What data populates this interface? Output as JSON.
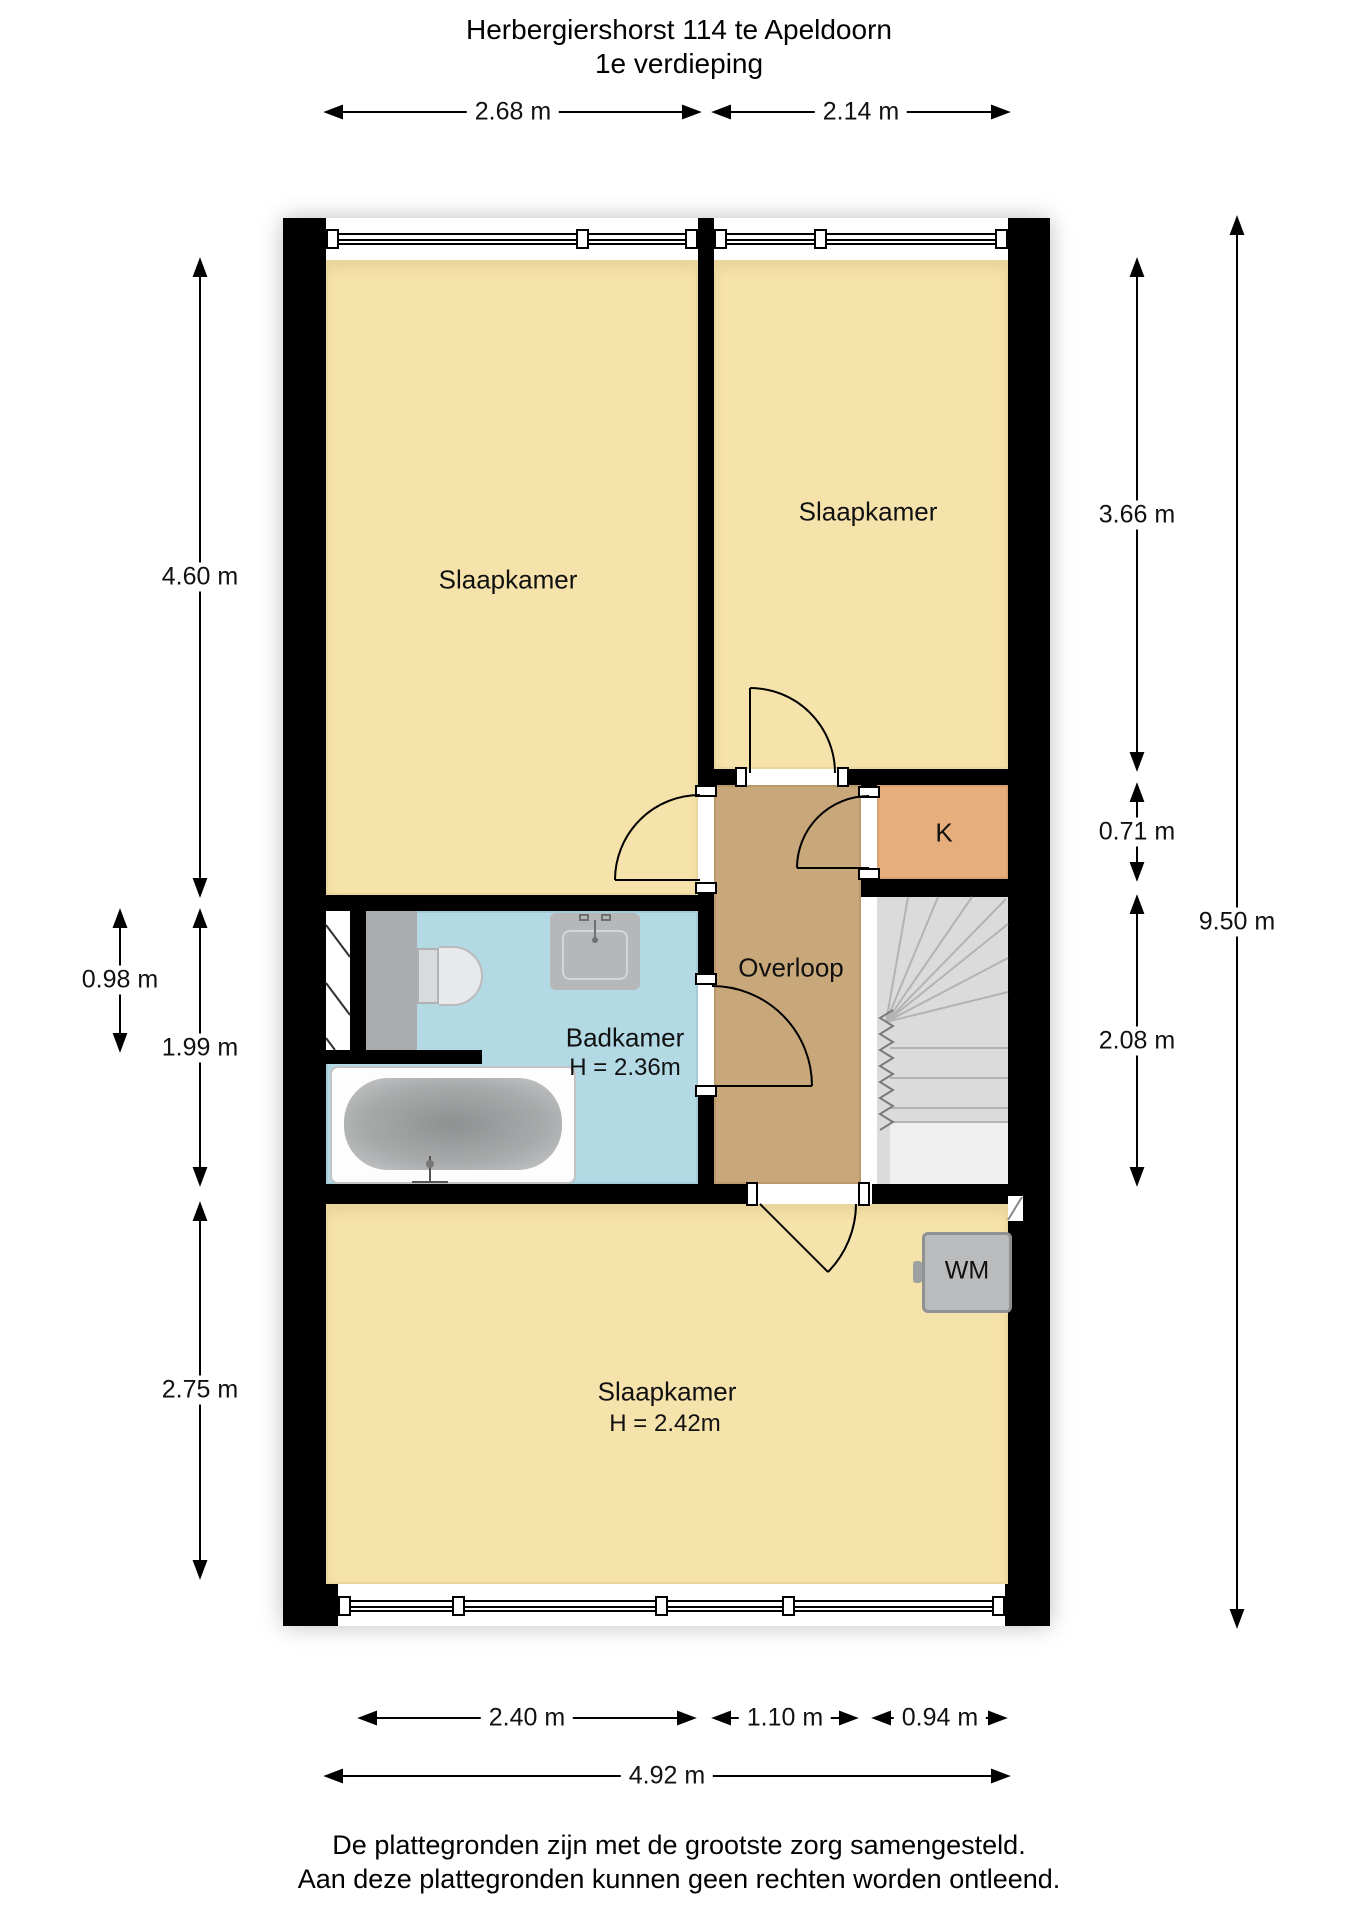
{
  "title": "Herbergiershorst 114 te Apeldoorn",
  "subtitle": "1e verdieping",
  "footer": {
    "line1": "De plattegronden zijn met de grootste zorg samengesteld.",
    "line2": "Aan deze plattegronden kunnen geen rechten worden ontleend."
  },
  "rooms": {
    "bedroom_top_left": {
      "label": "Slaapkamer"
    },
    "bedroom_top_right": {
      "label": "Slaapkamer"
    },
    "closet": {
      "label": "K"
    },
    "landing": {
      "label": "Overloop"
    },
    "bathroom": {
      "label": "Badkamer",
      "height": "H = 2.36m"
    },
    "bedroom_bottom": {
      "label": "Slaapkamer",
      "height": "H = 2.42m"
    },
    "washing_machine": {
      "label": "WM"
    }
  },
  "dimensions": {
    "top": [
      "2.68 m",
      "2.14 m"
    ],
    "left": [
      "4.60 m",
      "0.98 m",
      "1.99 m",
      "2.75 m"
    ],
    "right": [
      "3.66 m",
      "0.71 m",
      "2.08 m",
      "9.50 m"
    ],
    "bottom": [
      "2.40 m",
      "1.10 m",
      "0.94 m",
      "4.92 m"
    ]
  },
  "colors": {
    "wall": "#000000",
    "room_floor": "#F6E3AB",
    "landing_floor": "#C8A87A",
    "closet_floor": "#E6AE7D",
    "bathroom_floor": "#B2D9E4",
    "stairs": "#DBDBDB",
    "fixture_gray": "#B9BBBC"
  }
}
